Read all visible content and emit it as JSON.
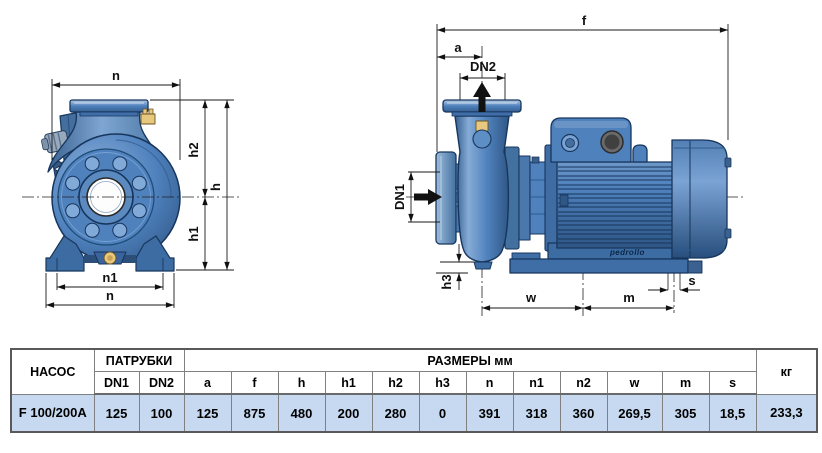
{
  "drawing": {
    "front_view": {
      "dim_labels": {
        "n_top": "n",
        "h2": "h2",
        "h": "h",
        "h1": "h1",
        "n1": "n1",
        "n_bottom": "n"
      }
    },
    "side_view": {
      "dim_labels": {
        "f": "f",
        "a": "a",
        "dn2": "DN2",
        "dn1": "DN1",
        "h3": "h3",
        "w": "w",
        "m": "m",
        "s": "s"
      },
      "brand": "pedrollo"
    },
    "colors": {
      "pump_blue": "#4f81bd",
      "outline_navy": "#17365d",
      "highlight_blue": "#9dbcdd",
      "brass": "#e7c87e"
    }
  },
  "table": {
    "col_pump": "НАСОС",
    "col_ports": "ПАТРУБКИ",
    "col_dims": "РАЗМЕРЫ мм",
    "col_weight": "кг",
    "subheaders": [
      "DN1",
      "DN2",
      "a",
      "f",
      "h",
      "h1",
      "h2",
      "h3",
      "n",
      "n1",
      "n2",
      "w",
      "m",
      "s"
    ],
    "row": {
      "model": "F 100/200A",
      "values": [
        "125",
        "100",
        "125",
        "875",
        "480",
        "200",
        "280",
        "0",
        "391",
        "318",
        "360",
        "269,5",
        "305",
        "18,5"
      ],
      "weight": "233,3"
    }
  }
}
